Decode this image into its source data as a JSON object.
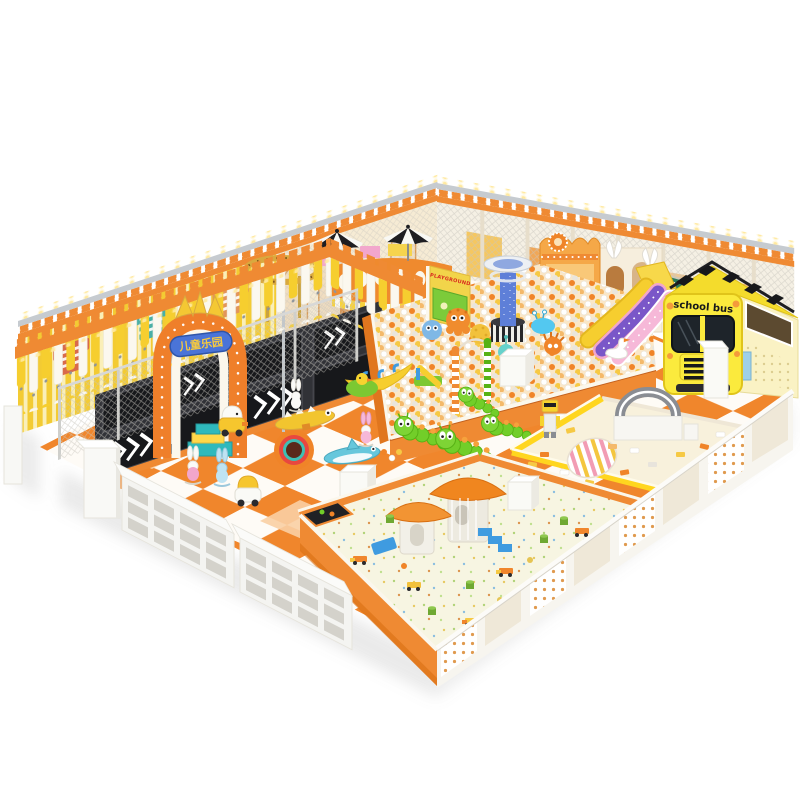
{
  "meta": {
    "description": "Isometric 3D render of an indoor children's soft-play playground on a white background, orange / yellow / white theme",
    "background_color": "#ffffff"
  },
  "texts": {
    "school_bus": "school bus",
    "playground_sign": "PLAYGROUND",
    "entrance_sign": "儿童乐园"
  },
  "palette": {
    "orange": "#EF8A33",
    "deep_orange": "#D86F12",
    "yellow": "#F6CE2F",
    "bus_yellow": "#FBEA3D",
    "cream": "#F5F0E4",
    "white": "#FFFFFF",
    "teal": "#35C6C5",
    "purple_slide": "#7A57C8",
    "pink_slide": "#F6B8D8",
    "caterpillar_green": "#72CE29",
    "sign_blue": "#4A74D8",
    "trampoline_black": "#1E1F23",
    "sand": "#F6F4E0",
    "rail_silver": "#C6CBD0",
    "gold": "#F4C833"
  },
  "zones": [
    {
      "name": "back-perimeter-wall",
      "desc": "cream mesh wall with posts, orange crenellation and festoon lights"
    },
    {
      "name": "yellow-striped-wall",
      "desc": "yellow striped wall decorated with striped t-shirt decals"
    },
    {
      "name": "trampoline-area",
      "desc": "black trampoline beds with white chevron arrows"
    },
    {
      "name": "orange-canopy",
      "desc": "crenellated orange pergola with hanging yellow and white strips"
    },
    {
      "name": "safety-net-fence",
      "desc": "grey netting in front of trampolines"
    },
    {
      "name": "entrance-arch",
      "desc": "orange light-bulb arch with gold crown and blue Chinese sign"
    },
    {
      "name": "crown-ring",
      "desc": "gold crown-shaped ring structure on posts"
    },
    {
      "name": "orange-rotunda",
      "desc": "round orange deck with porthole windows, striped skirt and two black-white umbrellas"
    },
    {
      "name": "ball-pit",
      "desc": "large pit of white, orange and yellow balls with animal floats and ball fountain tower"
    },
    {
      "name": "playground-screen",
      "desc": "yellow sign board with red PLAYGROUND letters over a green interactive screen"
    },
    {
      "name": "castle-facade",
      "desc": "orange castle wall with sun medallion and arch door"
    },
    {
      "name": "wave-slides",
      "desc": "yellow, purple and pink sparkle wave slides into the ball pit"
    },
    {
      "name": "climbing-web-panels",
      "desc": "green spider-web climbing panels"
    },
    {
      "name": "school-bus",
      "desc": "yellow school bus soft play structure with checkered roof rack"
    },
    {
      "name": "caterpillar-carousel",
      "desc": "green caterpillar ride with candy striped poles"
    },
    {
      "name": "floor-toys",
      "desc": "duck cars, bunny rockers, crocodile and shark seesaws, rainbow tunnel, banana boat"
    },
    {
      "name": "building-block-zone",
      "desc": "EPP block area with striped egg, grey arch block house and robot"
    },
    {
      "name": "sand-pit",
      "desc": "white sand pit with mushroom-roof playhouse and scattered beach toys"
    },
    {
      "name": "shoe-cubbies",
      "desc": "white storage shelves along the front edge"
    },
    {
      "name": "polka-dot-wall",
      "desc": "white safety wall with orange polka-dot panels"
    }
  ]
}
